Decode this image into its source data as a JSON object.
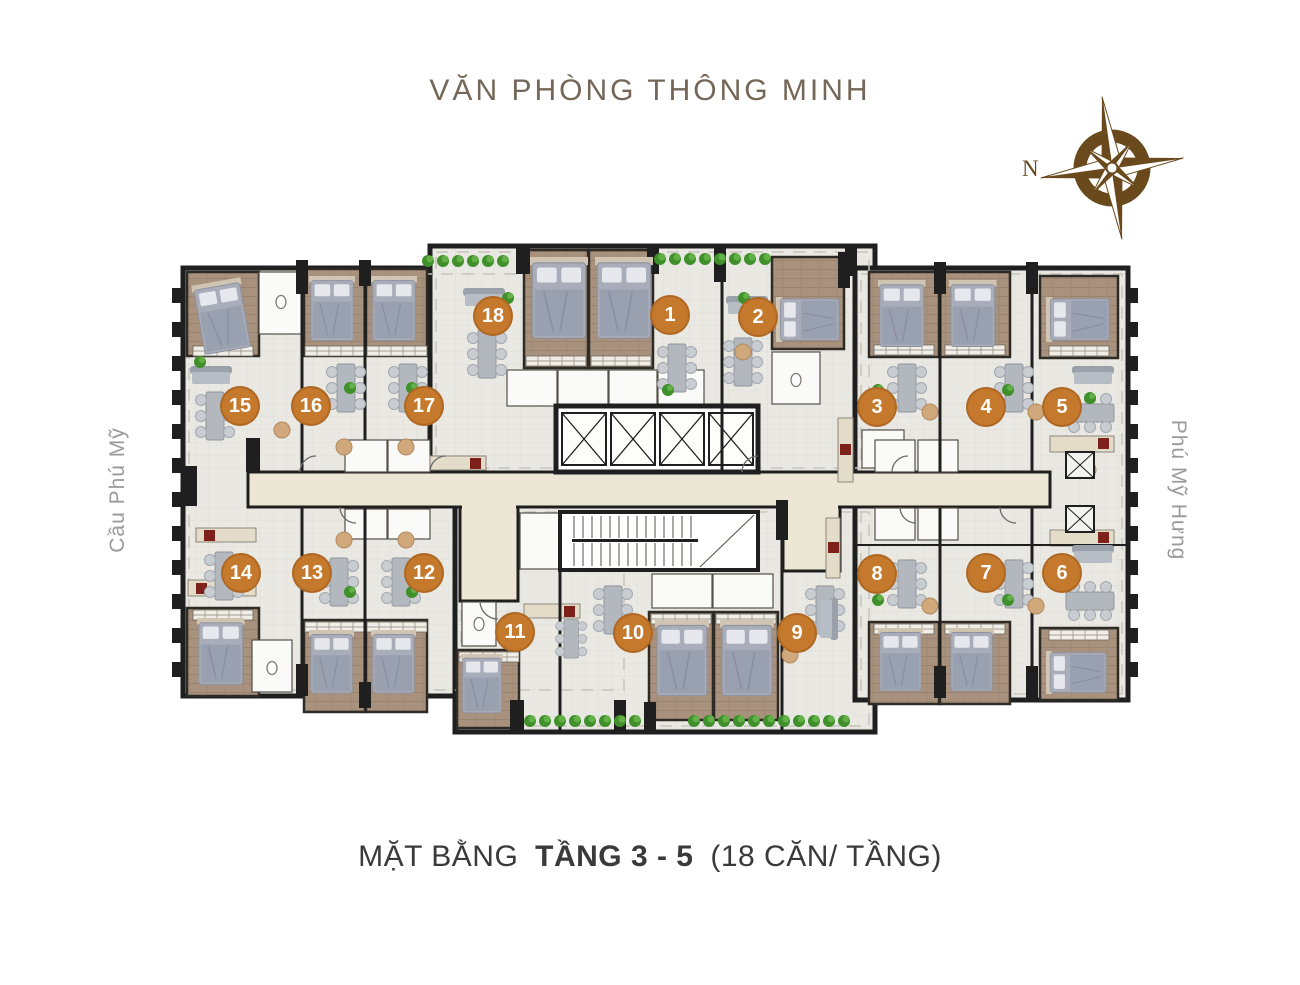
{
  "title": "VĂN PHÒNG THÔNG MINH",
  "caption": {
    "prefix": "MẶT BẰNG",
    "bold": "TẦNG 3 - 5",
    "suffix": "(18 CĂN/ TẦNG)"
  },
  "labels": {
    "left_street": "Cầu Phú Mỹ",
    "right_street": "Phú Mỹ Hưng",
    "compass_north": "N"
  },
  "units": [
    {
      "number": "1",
      "x": 670,
      "y": 315
    },
    {
      "number": "2",
      "x": 758,
      "y": 317
    },
    {
      "number": "3",
      "x": 877,
      "y": 407
    },
    {
      "number": "4",
      "x": 986,
      "y": 407
    },
    {
      "number": "5",
      "x": 1062,
      "y": 407
    },
    {
      "number": "6",
      "x": 1062,
      "y": 573
    },
    {
      "number": "7",
      "x": 986,
      "y": 573
    },
    {
      "number": "8",
      "x": 877,
      "y": 574
    },
    {
      "number": "9",
      "x": 797,
      "y": 633
    },
    {
      "number": "10",
      "x": 633,
      "y": 633
    },
    {
      "number": "11",
      "x": 515,
      "y": 632
    },
    {
      "number": "12",
      "x": 424,
      "y": 573
    },
    {
      "number": "13",
      "x": 312,
      "y": 573
    },
    {
      "number": "14",
      "x": 241,
      "y": 573
    },
    {
      "number": "15",
      "x": 240,
      "y": 406
    },
    {
      "number": "16",
      "x": 311,
      "y": 406
    },
    {
      "number": "17",
      "x": 424,
      "y": 406
    },
    {
      "number": "18",
      "x": 493,
      "y": 316
    }
  ],
  "colors": {
    "badge": "#c5792c",
    "title": "#756758",
    "caption": "#3a3a3a",
    "street": "#9a9a9a",
    "compass": "#6a4a1c",
    "corridor": "#ece7d4",
    "floor": "#e9e8e2",
    "bedroom": "#a8927d",
    "wall": "#1f1f1f",
    "plant": "#3f8f2b"
  }
}
